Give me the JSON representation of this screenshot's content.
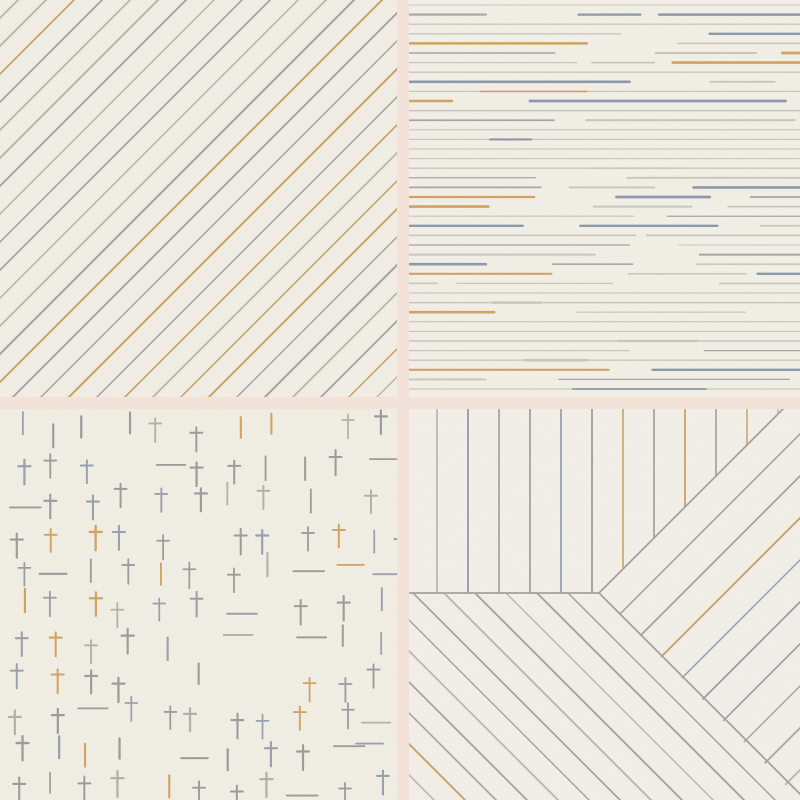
{
  "canvas": {
    "width": 800,
    "height": 800,
    "gutter_color": "#f4e3d9",
    "panel_background": "#f1eee5"
  },
  "texture": {
    "base_frequency": 0.8,
    "octaves": 2,
    "opacity": 0.05
  },
  "palette": {
    "gray": "#a5a3a0",
    "light_gray": "#c9c6bd",
    "slate_blue": "#8d98ab",
    "tan": "#cfa36a"
  },
  "panels": [
    {
      "id": "diagonal-stripes",
      "pos": {
        "x": 0,
        "y": 0,
        "w": 397,
        "h": 397
      },
      "bg": "#f1eee5",
      "type": "diagonal_stripes",
      "seed": 11,
      "spacing": 28,
      "offset": 18,
      "stroke_width": 1.8,
      "colors": [
        [
          "#a5a3a0",
          0.48
        ],
        [
          "#b8b5ad",
          0.22
        ],
        [
          "#c9a36a",
          0.17
        ],
        [
          "#9aa5b5",
          0.13
        ]
      ]
    },
    {
      "id": "dashed-rows",
      "pos": {
        "x": 409,
        "y": 0,
        "w": 391,
        "h": 397
      },
      "bg": "#f2efe6",
      "type": "dashed_rows",
      "seed": 23,
      "row_spacing": 9.6,
      "row_offset": 5,
      "full_row_chance": 0.28,
      "dash_min": 60,
      "dash_max": 260,
      "gap_min": 10,
      "gap_max": 110,
      "accent_colors": [
        "#8d98ab",
        "#d2a262"
      ],
      "colors": [
        [
          "#c9c6bd",
          0.4
        ],
        [
          "#a8a5a0",
          0.3
        ],
        [
          "#8d98ab",
          0.14
        ],
        [
          "#d2a262",
          0.16
        ]
      ]
    },
    {
      "id": "cross-scatter",
      "pos": {
        "x": 0,
        "y": 409,
        "w": 397,
        "h": 391
      },
      "bg": "#f1eee4",
      "type": "cross_scatter",
      "seed": 5,
      "cell": 36,
      "jitter": 9,
      "stroke_width": 2,
      "glyphs": [
        [
          "cross",
          0.58
        ],
        [
          "vbar",
          0.2
        ],
        [
          "hbar",
          0.14
        ],
        [
          "none",
          0.08
        ]
      ],
      "cross": {
        "above": 8,
        "below": 14,
        "bar_half": 6,
        "bar_rise": 3
      },
      "vbar_half": 10,
      "hbar_half": 13,
      "colors": [
        [
          "#9b9b9b",
          0.4
        ],
        [
          "#98a0ac",
          0.28
        ],
        [
          "#d2a25e",
          0.22
        ],
        [
          "#b3b0aa",
          0.1
        ]
      ]
    },
    {
      "id": "pinwheel-stripes",
      "pos": {
        "x": 409,
        "y": 409,
        "w": 391,
        "h": 391
      },
      "bg": "#f2efe7",
      "type": "pinwheel",
      "seed": 42,
      "junction": {
        "x": 190,
        "y": 184
      },
      "spacing": 31,
      "diag_spacing": 42,
      "first_vertical": 28,
      "stroke_width": 1.7,
      "boundary_color": "#a3a19d",
      "colors": [
        [
          "#a5a3a0",
          0.42
        ],
        [
          "#bab7ae",
          0.2
        ],
        [
          "#c9a36a",
          0.22
        ],
        [
          "#939daf",
          0.16
        ]
      ]
    }
  ]
}
